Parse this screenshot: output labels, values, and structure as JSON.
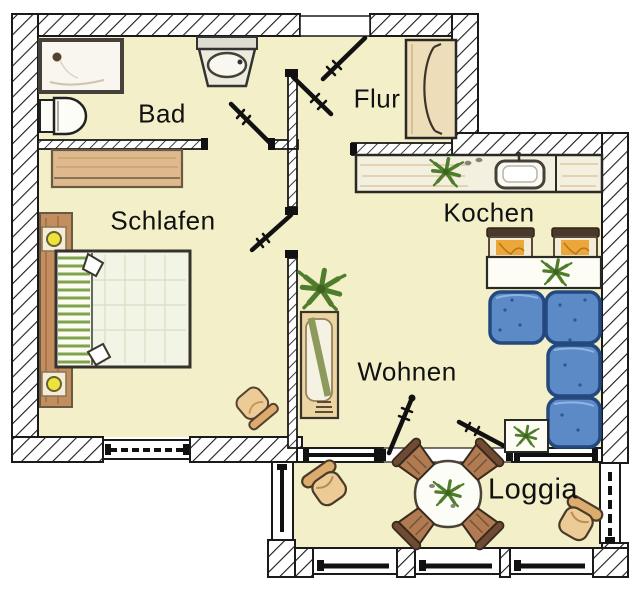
{
  "plan": {
    "rooms": {
      "bad": {
        "label": "Bad"
      },
      "flur": {
        "label": "Flur"
      },
      "schlafen": {
        "label": "Schlafen"
      },
      "kochen": {
        "label": "Kochen"
      },
      "wohnen": {
        "label": "Wohnen"
      },
      "loggia": {
        "label": "Loggia"
      }
    },
    "colors": {
      "floor": "#f2efc9",
      "wall_line": "#1a1a1a",
      "sofa_blue": "#5b8ac7",
      "wood_tan": "#ddb98d",
      "dining_seat_orange": "#eda63a",
      "loggia_chair_brown": "#b07a52",
      "lounge_chair_beige": "#eccb96",
      "plant_green": "#4f7d2c",
      "lamp_yellow": "#ece43c"
    },
    "furniture": [
      "bathtub",
      "toilet",
      "washbasin",
      "flur-wardrobe",
      "kitchen-counter",
      "kitchen-sink",
      "dining-chairs",
      "dining-table",
      "corner-sofa",
      "side-table",
      "shelf-cabinet",
      "floor-plant",
      "schlafen-wardrobe",
      "bed",
      "bedside-lamps",
      "bedroom-chair",
      "loggia-table",
      "loggia-chairs",
      "lounge-chairs"
    ]
  }
}
